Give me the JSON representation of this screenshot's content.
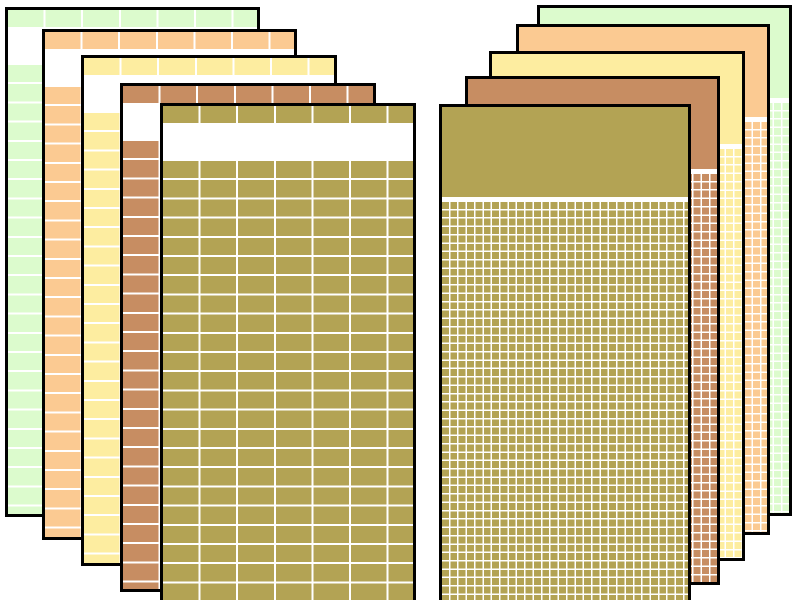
{
  "page": {
    "description": "Two cascaded fans of colored spreadsheet window panels on a white background, no visible text",
    "background": "#ffffff",
    "panel_border_color": "#000000",
    "gridline_color": "#ffffff"
  },
  "panel_style": {
    "left": {
      "grid": "coarse",
      "header_h": 17,
      "gap_h": 38,
      "cell_w": 37.6,
      "cell_h": 19.2,
      "line": 2
    },
    "right": {
      "grid": "fine",
      "header_h": 90,
      "gap_h": 5,
      "cell_w": 8.36,
      "cell_h": 8.36,
      "line": 1.5
    }
  },
  "stacks": [
    {
      "name": "left",
      "panels": [
        {
          "color_name": "green",
          "fill": "#dcfbcd",
          "x": 5,
          "y": 7,
          "w": 255,
          "h": 510
        },
        {
          "color_name": "orange",
          "fill": "#fbca92",
          "x": 42,
          "y": 29,
          "w": 255,
          "h": 511
        },
        {
          "color_name": "yellow",
          "fill": "#fdeda0",
          "x": 81,
          "y": 55,
          "w": 256,
          "h": 511
        },
        {
          "color_name": "brown",
          "fill": "#c78d62",
          "x": 120,
          "y": 83,
          "w": 256,
          "h": 509
        },
        {
          "color_name": "olive",
          "fill": "#b3a354",
          "x": 160,
          "y": 103,
          "w": 256,
          "h": 512
        }
      ]
    },
    {
      "name": "right",
      "panels": [
        {
          "color_name": "green",
          "fill": "#dcfbcd",
          "x": 537,
          "y": 5,
          "w": 255,
          "h": 511
        },
        {
          "color_name": "orange",
          "fill": "#fbca92",
          "x": 516,
          "y": 24,
          "w": 254,
          "h": 511
        },
        {
          "color_name": "yellow",
          "fill": "#fdeda0",
          "x": 489,
          "y": 51,
          "w": 256,
          "h": 510
        },
        {
          "color_name": "brown",
          "fill": "#c78d62",
          "x": 465,
          "y": 76,
          "w": 255,
          "h": 509
        },
        {
          "color_name": "olive",
          "fill": "#b3a354",
          "x": 439,
          "y": 104,
          "w": 252,
          "h": 512
        }
      ]
    }
  ]
}
